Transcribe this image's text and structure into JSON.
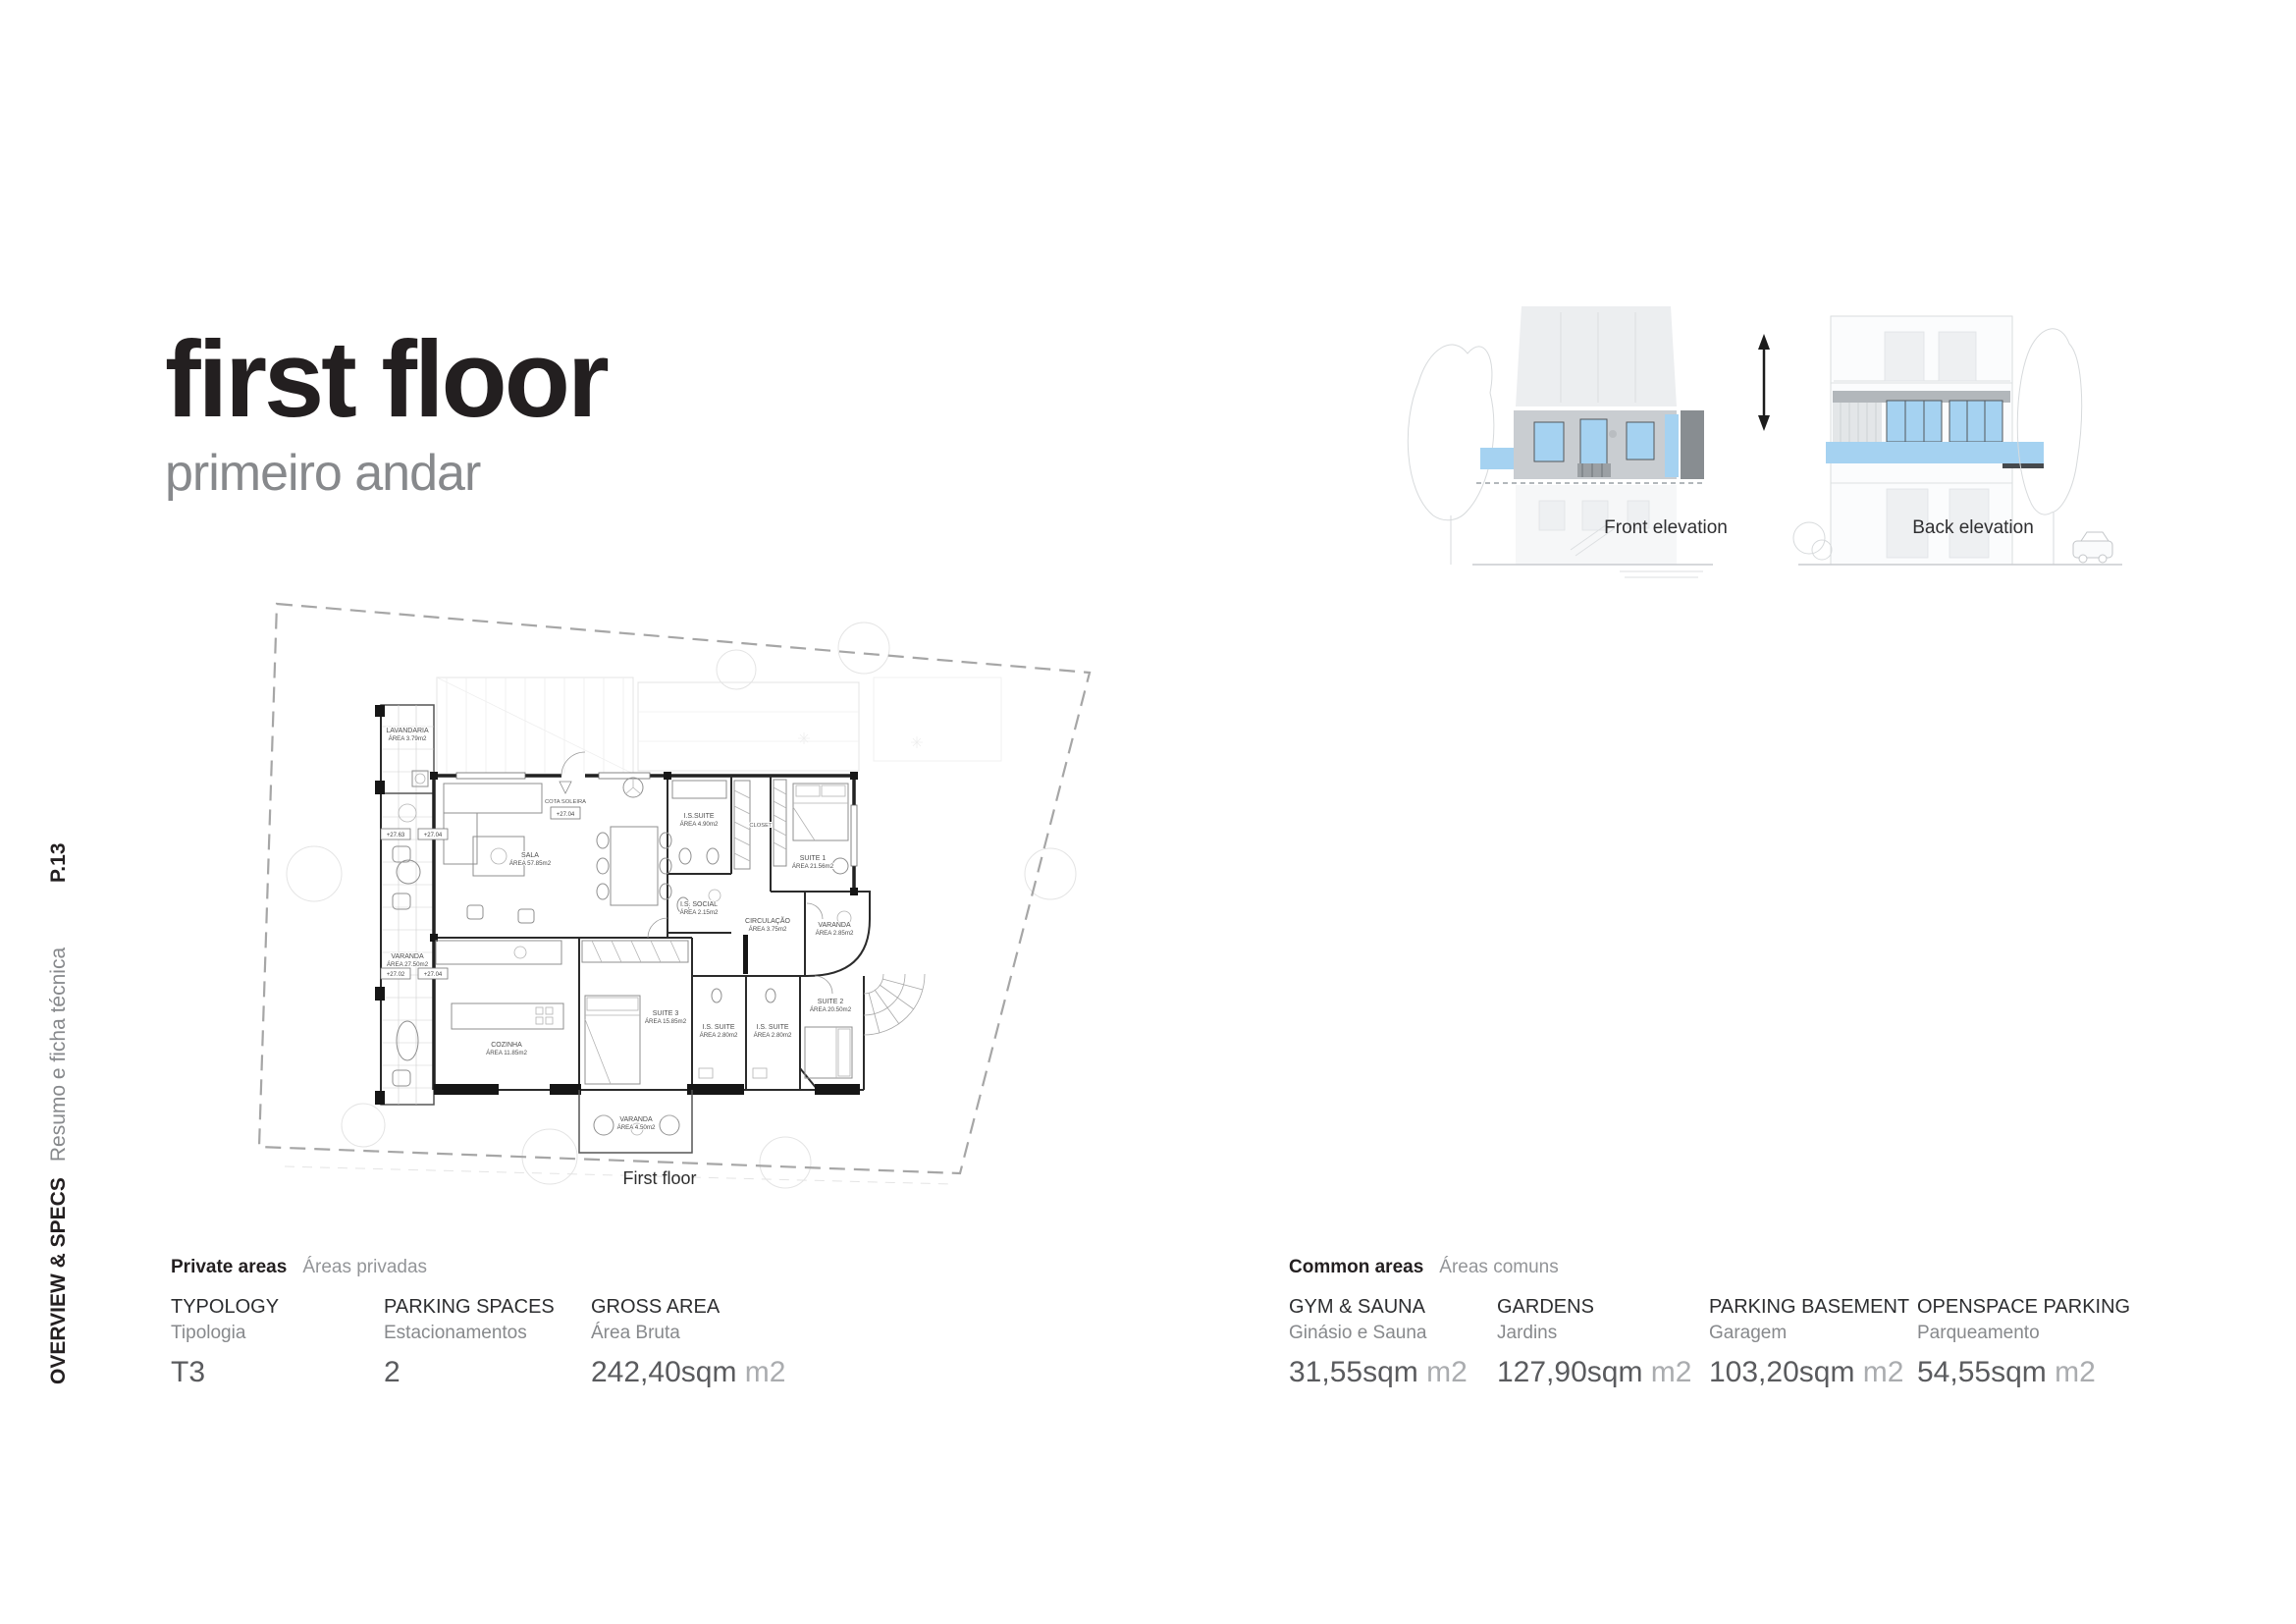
{
  "page": {
    "title": "first floor",
    "subtitle": "primeiro andar",
    "page_number": "P.13",
    "section_label": "OVERVIEW & SPECS",
    "section_sublabel": "Resumo e ficha técnica"
  },
  "elevations": {
    "front_label": "Front elevation",
    "back_label": "Back elevation"
  },
  "floor_plan": {
    "caption": "First floor",
    "cota_label": "COTA SOLEIRA",
    "cota_value": "+27.04",
    "levels": [
      "+27.63",
      "+27.04",
      "+27.02",
      "+27.04"
    ],
    "rooms": {
      "lavandaria": {
        "name": "LAVANDARIA",
        "area": "ÁREA 3.79m2"
      },
      "sala": {
        "name": "SALA",
        "area": "ÁREA 57.85m2"
      },
      "varanda_left": {
        "name": "VARANDA",
        "area": "ÁREA 27.50m2"
      },
      "is_suite_top": {
        "name": "I.S.SUITE",
        "area": "ÁREA 4.90m2"
      },
      "closet": {
        "name": "CLOSET",
        "area": ""
      },
      "suite1": {
        "name": "SUITE 1",
        "area": "ÁREA 21.56m2"
      },
      "is_social": {
        "name": "I.S. SOCIAL",
        "area": "ÁREA 2.15m2"
      },
      "circulacao": {
        "name": "CIRCULAÇÃO",
        "area": "ÁREA 3.75m2"
      },
      "varanda_right": {
        "name": "VARANDA",
        "area": "ÁREA 2.85m2"
      },
      "cozinha": {
        "name": "COZINHA",
        "area": "ÁREA 11.85m2"
      },
      "suite3": {
        "name": "SUITE 3",
        "area": "ÁREA 15.85m2"
      },
      "is_suite_left": {
        "name": "I.S. SUITE",
        "area": "ÁREA 2.80m2"
      },
      "is_suite_right": {
        "name": "I.S. SUITE",
        "area": "ÁREA 2.80m2"
      },
      "suite2": {
        "name": "SUITE 2",
        "area": "ÁREA 20.50m2"
      },
      "varanda_bottom": {
        "name": "VARANDA",
        "area": "ÁREA 4.50m2"
      }
    }
  },
  "private_areas": {
    "heading": "Private areas",
    "subheading": "Áreas privadas",
    "specs": [
      {
        "label": "TYPOLOGY",
        "sublabel": "Tipologia",
        "value": "T3",
        "unit": ""
      },
      {
        "label": "PARKING SPACES",
        "sublabel": "Estacionamentos",
        "value": "2",
        "unit": ""
      },
      {
        "label": "GROSS AREA",
        "sublabel": "Área Bruta",
        "value": "242,40sqm",
        "unit": "m2"
      }
    ]
  },
  "common_areas": {
    "heading": "Common areas",
    "subheading": "Áreas comuns",
    "specs": [
      {
        "label": "GYM & SAUNA",
        "sublabel": "Ginásio e Sauna",
        "value": "31,55sqm",
        "unit": "m2"
      },
      {
        "label": "GARDENS",
        "sublabel": "Jardins",
        "value": "127,90sqm",
        "unit": "m2"
      },
      {
        "label": "PARKING BASEMENT",
        "sublabel": "Garagem",
        "value": "103,20sqm",
        "unit": "m2"
      },
      {
        "label": "OPENSPACE PARKING",
        "sublabel": "Parqueamento",
        "value": "54,55sqm",
        "unit": "m2"
      }
    ]
  },
  "colors": {
    "accent_blue": "#a5d2f1",
    "highlight_gray": "#c9cdd1",
    "dark_panel": "#888d91",
    "text_dark": "#231f20",
    "text_gray": "#87898c",
    "value_gray": "#5a5b5e",
    "unit_gray": "#aaacaf"
  }
}
